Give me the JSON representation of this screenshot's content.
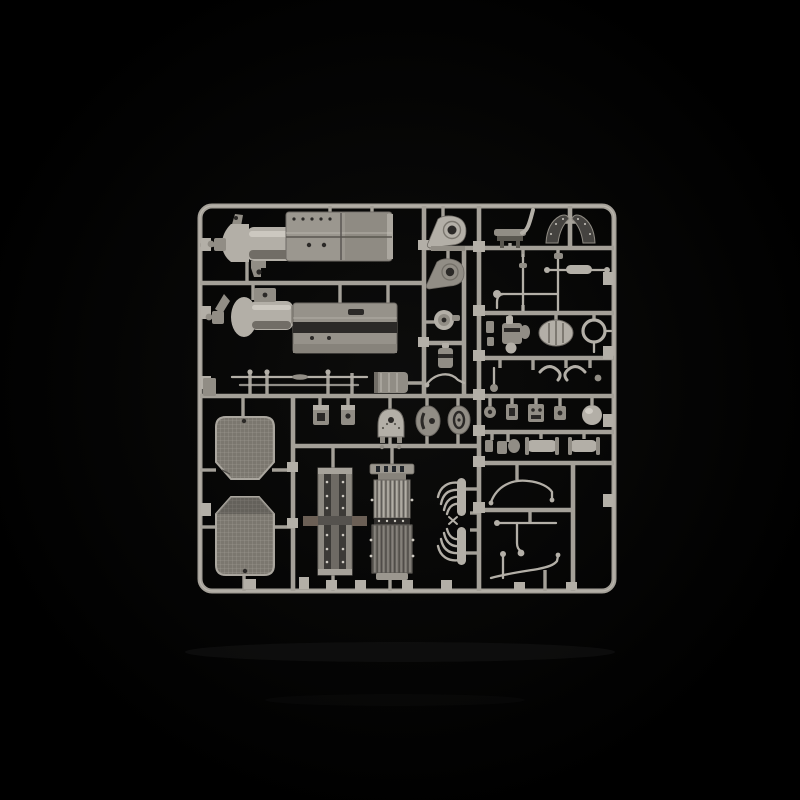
{
  "scene": {
    "subject": "plastic-model-kit-sprue",
    "background": "black-studio-backdrop"
  },
  "palette": {
    "bg": "#000000",
    "runner": "#a4a098",
    "runner_hi": "#cdc9c1",
    "part_light": "#b3afa7",
    "part_mid": "#918d85",
    "part_dark": "#5a5750",
    "recess": "#2b2927",
    "dark_part": "#454340",
    "mesh": "#7b776f",
    "reflect": "#161616"
  },
  "sprue": {
    "material": "grey-styrene",
    "parts": [
      "engine-transmission-half-upper",
      "engine-transmission-half-lower",
      "side-panel-upper",
      "side-panel-lower",
      "engine-mount-teardrop-upper",
      "engine-mount-teardrop-lower",
      "pulley-wheel",
      "small-canister",
      "bench-seat",
      "mudguard-left",
      "mudguard-right",
      "steering-rod-pair",
      "tie-rod",
      "elbow-rod",
      "carburetor",
      "oval-air-tank",
      "ring-gasket",
      "hook-brackets",
      "small-fittings-row",
      "axle-housing-pair",
      "radiator-grille-upper",
      "radiator-grille-lower",
      "thin-axle-rods",
      "ribbed-cylinder",
      "firewall-dome",
      "oval-plate-left",
      "oval-plate-right",
      "small-box-left",
      "small-box-right",
      "chassis-ladder-frame",
      "radiator-core",
      "exhaust-manifold-pair",
      "fuel-pipe-curved",
      "fuel-pipe-tee",
      "fuel-pipe-long",
      "ball-joint"
    ]
  }
}
